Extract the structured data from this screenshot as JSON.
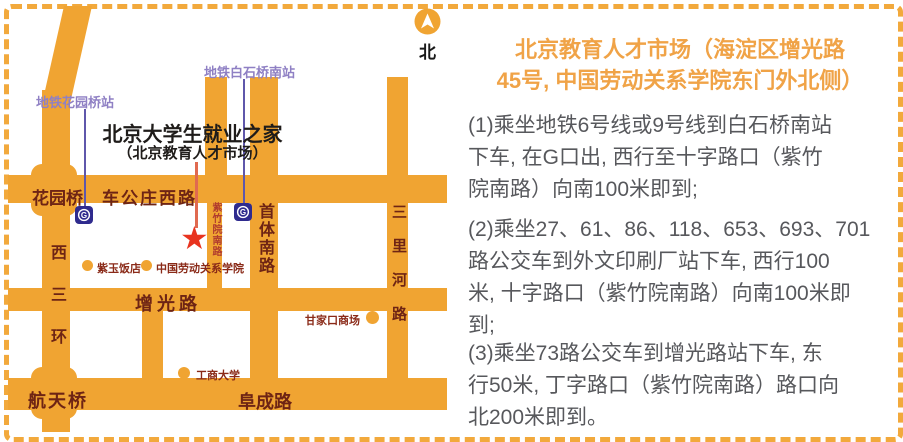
{
  "north": {
    "label": "北"
  },
  "icons": {
    "star": "★"
  },
  "map": {
    "title": "北京大学生就业之家",
    "subtitle": "（北京教育人才市场）",
    "stations": {
      "huayuanqiao": "地铁花园桥站",
      "baishiqiao_south": "地铁白石桥南站"
    },
    "roads": {
      "chegongzhuang_west": "车公庄西路",
      "huayuanqiao_bridge": "花园桥",
      "zengguang": "增光路",
      "fucheng": "阜成路",
      "hangtian_bridge": "航天桥",
      "xisanhuan": "西三环",
      "shouti_south": "首体南路",
      "zizhuyuan_south": "紫竹院南路",
      "sanlihe": "三里河路"
    },
    "pois": {
      "ziyu_hotel": "紫玉饭店",
      "labor_college": "中国劳动关系学院",
      "business_university": "工商大学",
      "ganjiakou_mall": "甘家口商场"
    }
  },
  "panel": {
    "title_lines": {
      "l1": "北京教育人才市场（海淀区增光路",
      "l2": "45号, 中国劳动关系学院东门外北侧）"
    },
    "directions": [
      {
        "lines": {
          "l1": "(1)乘坐地铁6号线或9号线到白石桥南站",
          "l2": "下车, 在G口出, 西行至十字路口（紫竹",
          "l3": "院南路）向南100米即到;"
        }
      },
      {
        "lines": {
          "l1": "(2)乘坐27、61、86、118、653、693、701",
          "l2": "路公交车到外文印刷厂站下车, 西行100",
          "l3": "米, 十字路口（紫竹院南路）向南100米即",
          "l4": "到;"
        }
      },
      {
        "lines": {
          "l1": "(3)乘坐73路公交车到增光路站下车, 东",
          "l2": "行50米, 丁字路口（紫竹院南路）路口向",
          "l3": "北200米即到。"
        }
      }
    ]
  },
  "colors": {
    "road_orange": "#F0A432",
    "border_orange": "#F2A93C",
    "road_label": "#6E2414",
    "station_purple": "#8F80C4",
    "metro_blue": "#2F2B8E",
    "star_red": "#E8331F",
    "panel_title_orange": "#F0A347",
    "body_gray": "#57585C"
  }
}
